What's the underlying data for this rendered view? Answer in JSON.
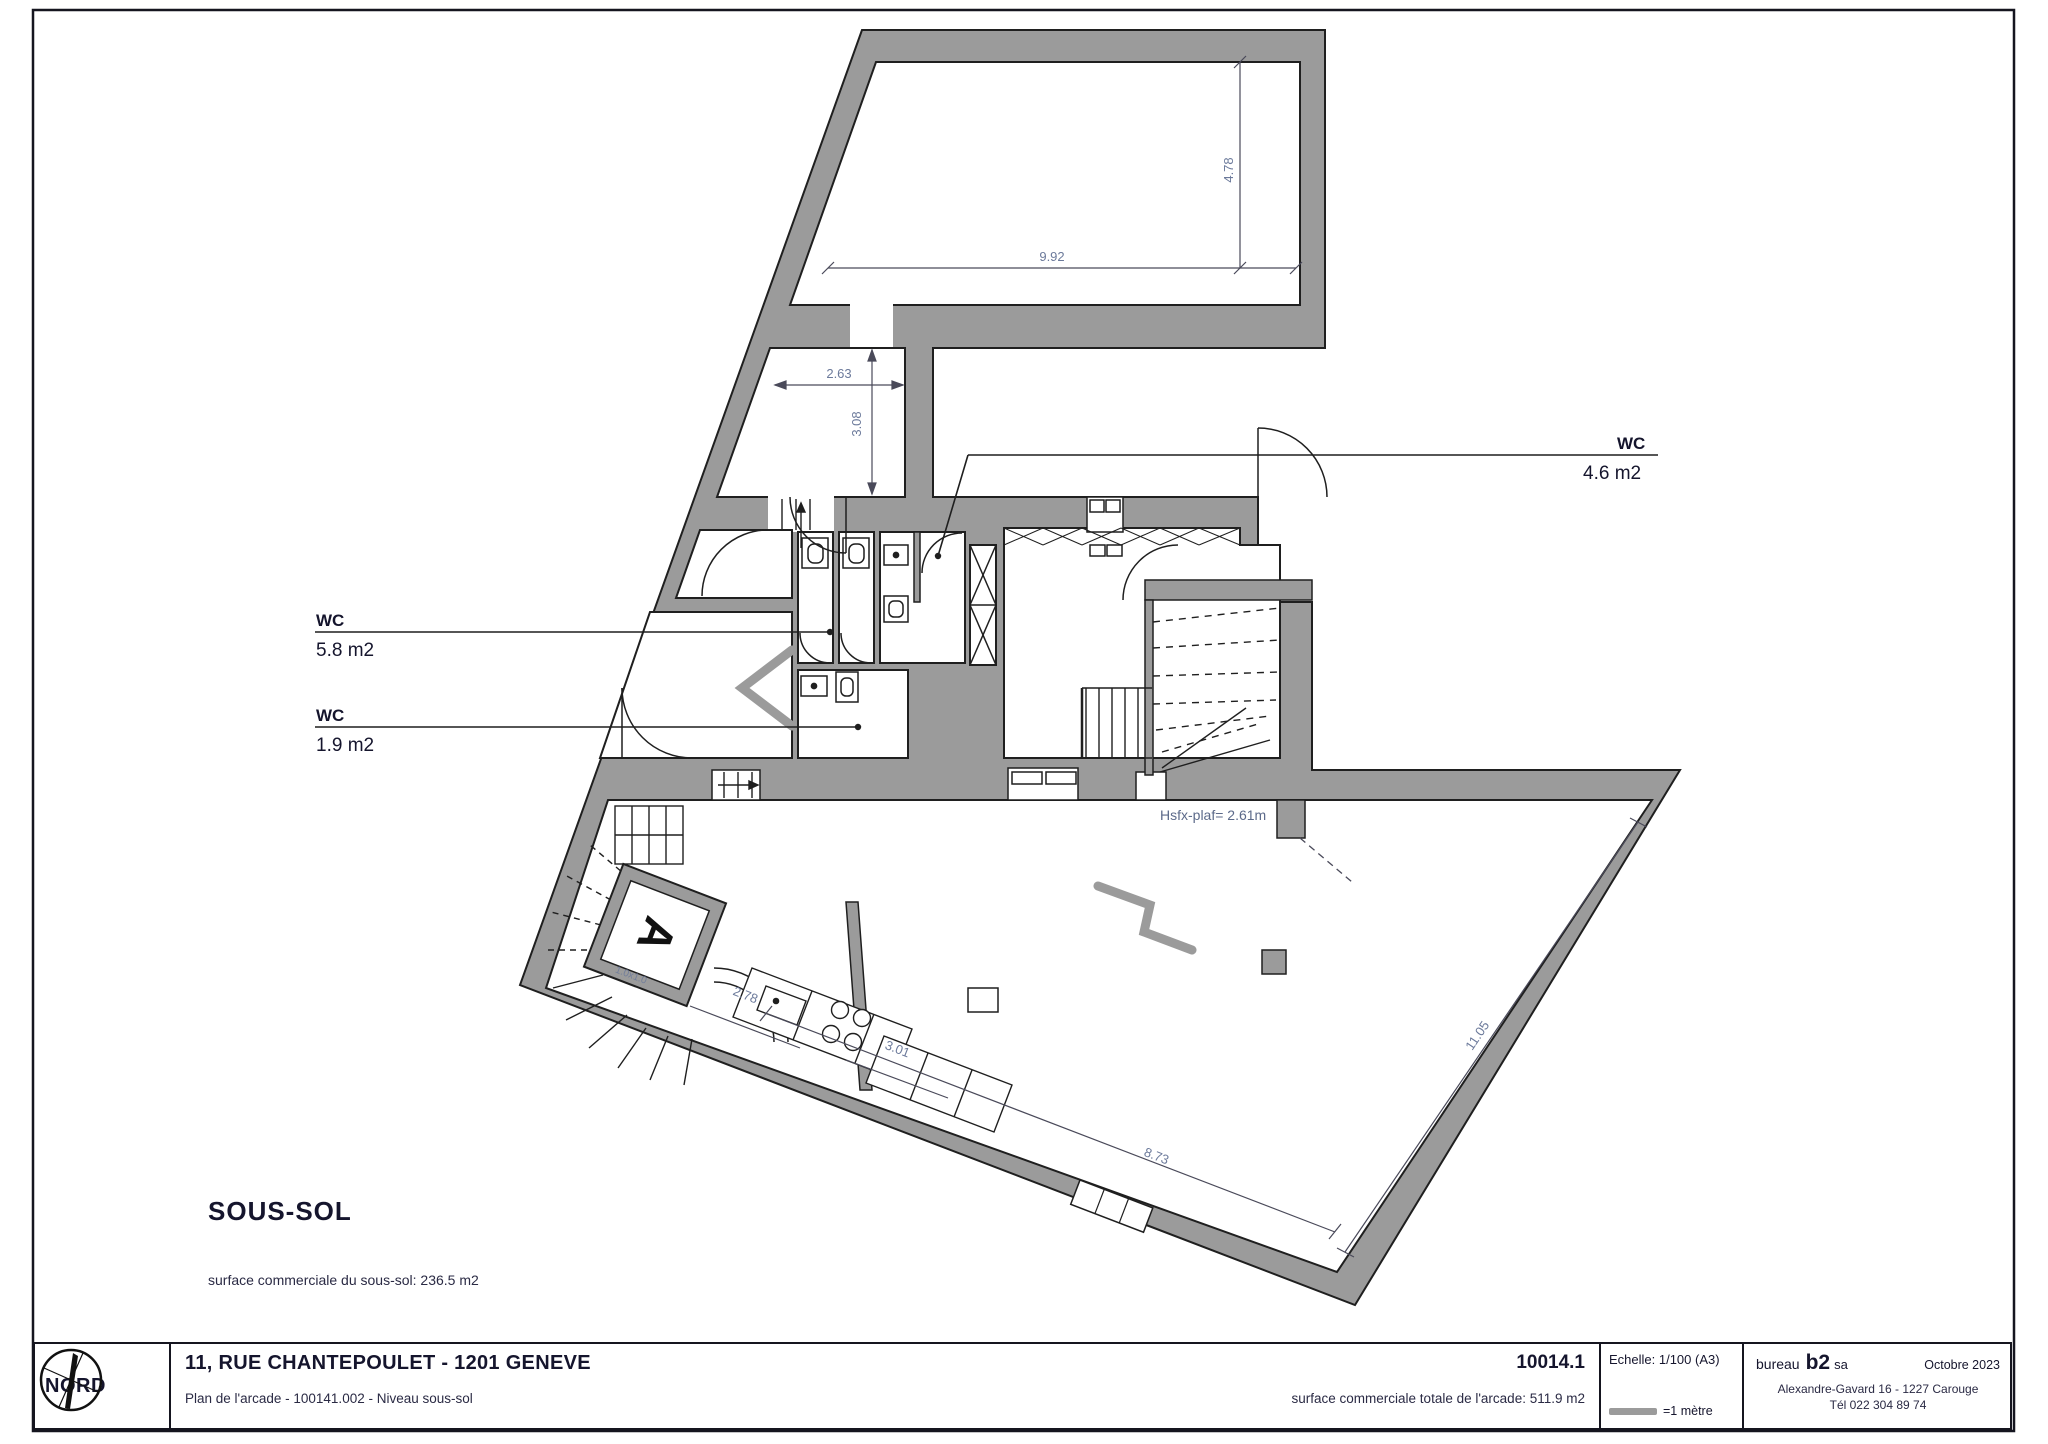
{
  "plan": {
    "room_labels": {
      "wc_top": {
        "title": "WC",
        "area": "4.6 m2"
      },
      "wc_mid": {
        "title": "WC",
        "area": "5.8 m2"
      },
      "wc_low": {
        "title": "WC",
        "area": "1.9 m2"
      }
    },
    "elevator_label": "A",
    "ceiling_note": "Hsfx-plaf= 2.61m",
    "stair_note": "1.0x1.0",
    "dims": {
      "top_width": "9.92",
      "top_depth": "4.78",
      "corridor_width": "2.63",
      "corridor_depth": "3.08",
      "kitchen_gap": "2.78",
      "kitchen_width": "3.01",
      "bottom_length": "8.73",
      "right_length": "11.05"
    },
    "level_title": "SOUS-SOL",
    "level_area_note": "surface commerciale du sous-sol: 236.5 m2"
  },
  "titleblock": {
    "north_label": "NORD",
    "address": "11, RUE CHANTEPOULET - 1201 GENEVE",
    "drawing_info": "Plan de l'arcade - 100141.002 - Niveau sous-sol",
    "drawing_number": "10014.1",
    "total_area": "surface commerciale totale de l'arcade: 511.9 m2",
    "scale_label": "Echelle: 1/100 (A3)",
    "scale_bar_label": "=1 mètre",
    "firm_prefix": "bureau",
    "firm_name": "b2",
    "firm_suffix": "sa",
    "date": "Octobre 2023",
    "firm_address": "Alexandre-Gavard 16  -  1227 Carouge",
    "firm_phone": "Tél 022 304 89 74"
  },
  "colors": {
    "wall": "#9b9b9b",
    "line": "#1f1f1f",
    "dim_text": "#6c7a9b",
    "text": "#15152d"
  }
}
